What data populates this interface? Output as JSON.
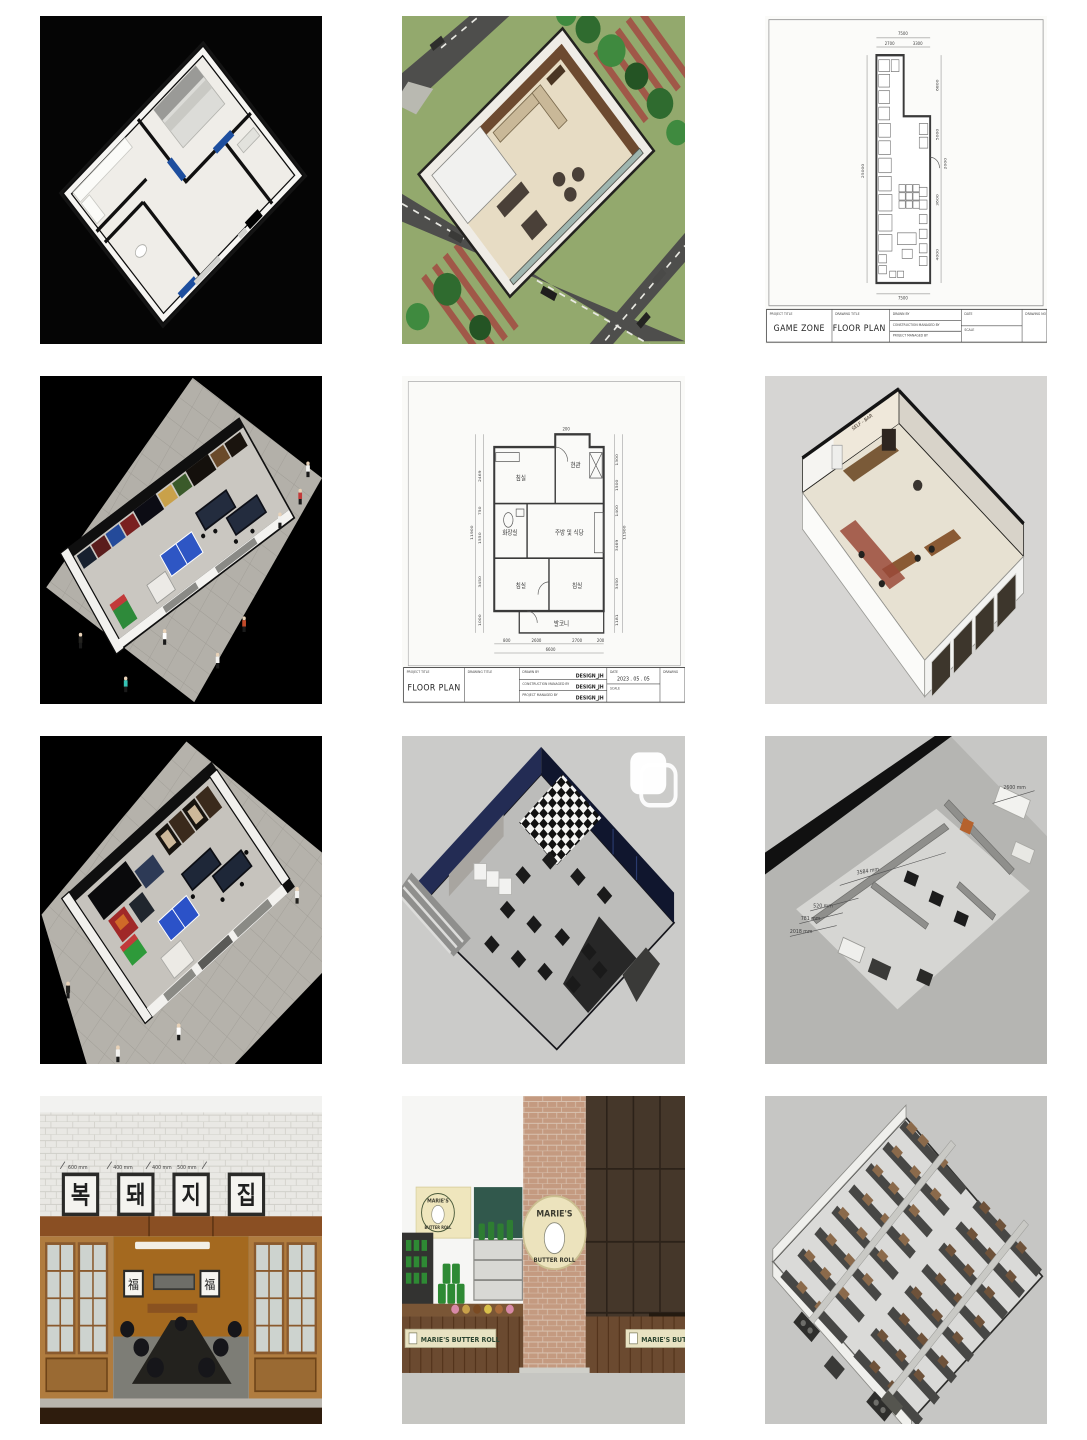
{
  "cells": [
    {
      "name": "apartment-3d-render-black"
    },
    {
      "name": "cafe-aerial-render"
    },
    {
      "name": "game-zone-floor-plan",
      "tb": {
        "project_title_label": "PROJECT TITLE",
        "project_title": "GAME ZONE",
        "drawing_title_label": "DRAWING TITLE",
        "drawing_title": "FLOOR PLAN",
        "drawn_by_label": "DRAWN BY",
        "construction_label": "CONSTRUCTION MANAGED BY",
        "managed_label": "PROJECT MANAGED BY",
        "date_label": "DATE",
        "scale_label": "SCALE",
        "drawing_no_label": "DRAWING NO"
      },
      "dims": {
        "top_total": "7500",
        "top_a": "2700",
        "top_b": "3300",
        "left_total": "25000",
        "right_a": "6800",
        "right_b": "5000",
        "right_c": "2000",
        "right_d": "3600",
        "right_e": "4000",
        "bottom_total": "7500"
      }
    },
    {
      "name": "arcade-hall-long-render"
    },
    {
      "name": "apartment-floor-plan",
      "tb": {
        "project_title_label": "PROJECT TITLE",
        "project_title": "FLOOR PLAN",
        "drawing_title_label": "DRAWING TITLE",
        "drawn_by_label": "DRAWN BY",
        "drawn_by": "DESIGN_JH",
        "construction_label": "CONSTRUCTION MANAGED BY",
        "construction_by": "DESIGN_JH",
        "managed_label": "PROJECT MANAGED BY",
        "managed_by": "DESIGN_JH",
        "date_label": "DATE",
        "date_value": "2023 . 05 . 05",
        "scale_label": "SCALE",
        "drawing_label": "DRAWING"
      },
      "rooms": {
        "bedroom_top": "침실",
        "entrance": "현관",
        "kitchen": "주방 및 식당",
        "bathroom": "화장실",
        "bedroom_left": "침실",
        "bedroom_right": "침실",
        "balcony": "발코니"
      },
      "dims": {
        "left_total": "11900",
        "l1": "2469",
        "l2": "750",
        "l3": "1550",
        "l4": "3450",
        "l5": "1000",
        "right_total": "11900",
        "r1": "1300",
        "r2": "1500",
        "r3": "1400",
        "r4": "3469",
        "r5": "3450",
        "r6": "1181",
        "t1": "200",
        "b1": "800",
        "b2": "2600",
        "b3": "2700",
        "b4": "200",
        "bottom_total": "6600"
      }
    },
    {
      "name": "restaurant-cutaway-render",
      "sign": "SELF - BAR"
    },
    {
      "name": "arcade-room-render"
    },
    {
      "name": "pc-room-render",
      "icon": "carousel-stack-icon"
    },
    {
      "name": "studio-3d-model",
      "dims": {
        "a": "3584 mm",
        "b": "520 mm",
        "c": "781 mm",
        "d": "2018 mm",
        "e": "2600 mm"
      }
    },
    {
      "name": "korean-bbq-facade",
      "dims": {
        "a": "600 mm",
        "b": "400 mm",
        "c": "400 mm",
        "d": "500 mm"
      },
      "sign": {
        "c1": "복",
        "c2": "돼",
        "c3": "지",
        "c4": "집"
      },
      "fu": "福"
    },
    {
      "name": "bakery-facade",
      "logo_top": "MARIE'S",
      "logo_bottom": "BUTTER ROLL",
      "banner": "MARIE'S BUTTER ROLL"
    },
    {
      "name": "warehouse-shelving-render"
    }
  ],
  "colors": {
    "paper": "#fbfbf9",
    "plan_line": "#3a3a3a",
    "black_bg": "#050505",
    "sketchup_bg": "#cbcbc9",
    "navy_wall": "#1d2850",
    "brick": "#c49a80",
    "cream": "#ece3bd",
    "wood": "#8a5a2e",
    "accent_blue": "#1d4e9e"
  }
}
